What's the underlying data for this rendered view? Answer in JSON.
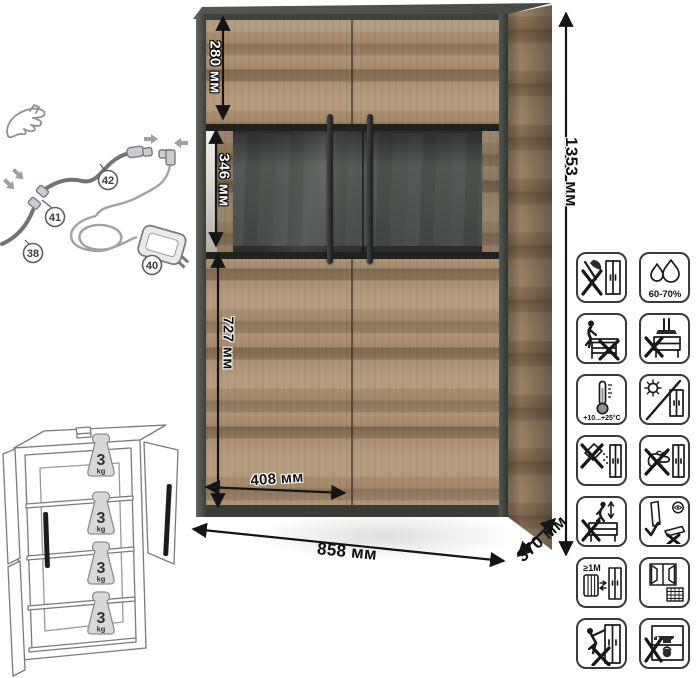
{
  "product": {
    "type": "display-cabinet-dimension-diagram"
  },
  "dimensions": {
    "top_section_height": "280 мм",
    "display_section_height": "346 мм",
    "lower_section_height": "727 мм",
    "door_width": "408 мм",
    "total_width": "858 мм",
    "depth": "370 мм",
    "total_height": "1353 мм"
  },
  "wiring": {
    "parts": [
      "38",
      "40",
      "41",
      "42"
    ]
  },
  "shelf_load": {
    "value": "3",
    "unit": "kg",
    "shelf_count": 4
  },
  "care_icons": [
    {
      "name": "no-sharp-tools"
    },
    {
      "name": "humidity-range",
      "text": "60-70%"
    },
    {
      "name": "no-sitting"
    },
    {
      "name": "no-top-pressure"
    },
    {
      "name": "temperature-range",
      "text": "+10...+25°C"
    },
    {
      "name": "no-direct-sunlight"
    },
    {
      "name": "no-abrasive-cleaners"
    },
    {
      "name": "no-scrubbing"
    },
    {
      "name": "no-jumping"
    },
    {
      "name": "transport-upright"
    },
    {
      "name": "keep-distance-from-heat",
      "text": "≥1M"
    },
    {
      "name": "ventilate-room"
    },
    {
      "name": "no-tipping"
    },
    {
      "name": "no-heavy-items-inside"
    }
  ],
  "colors": {
    "wood_light": "#b59c80",
    "wood_dark": "#8d755a",
    "frame_dark": "#464844",
    "glass_back": "#555a56",
    "dimension_line": "#151515",
    "icon_outline": "#3a3a3a"
  }
}
